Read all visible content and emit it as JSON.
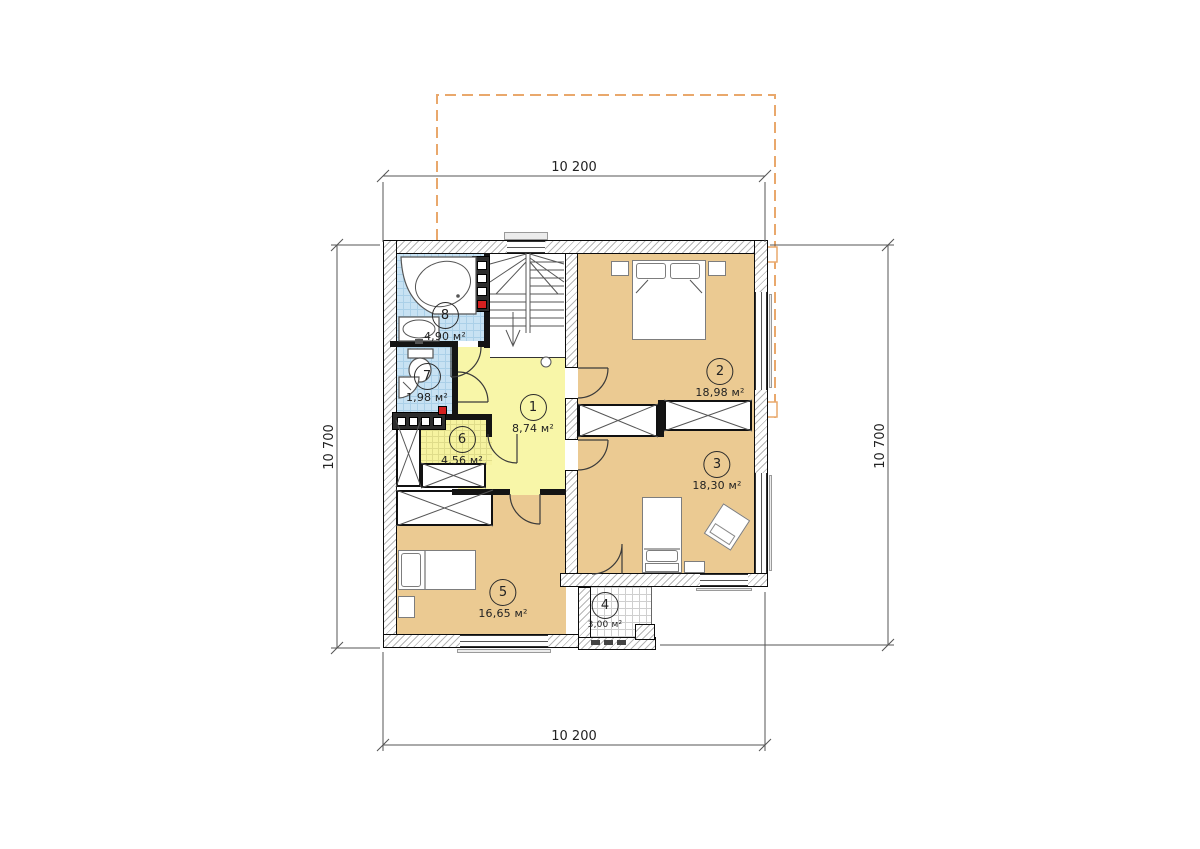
{
  "plan": {
    "dimensions": {
      "top": "10 200",
      "bottom": "10 200",
      "left": "10 700",
      "right": "10 700"
    },
    "rooms": [
      {
        "number": "1",
        "area": "8,74 м²"
      },
      {
        "number": "2",
        "area": "18,98 м²"
      },
      {
        "number": "3",
        "area": "18,30 м²"
      },
      {
        "number": "4",
        "area": "3,00 м²"
      },
      {
        "number": "5",
        "area": "16,65 м²"
      },
      {
        "number": "6",
        "area": "4,56 м²"
      },
      {
        "number": "7",
        "area": "1,98 м²"
      },
      {
        "number": "8",
        "area": "4,90 м²"
      }
    ],
    "colors": {
      "bedroom_floor": "#ebca92",
      "hall_floor": "#f8f6a8",
      "wet_room_floor": "#c8e2f3",
      "roof_outline": "#e9a86c",
      "vent_marker": "#d42020"
    }
  }
}
